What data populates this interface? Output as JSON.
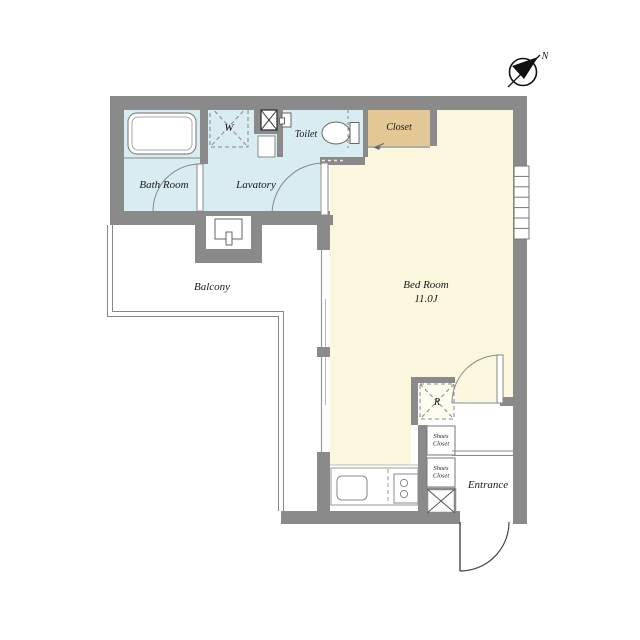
{
  "floorplan": {
    "rooms": {
      "bath": {
        "label": "Bath Room"
      },
      "lavatory": {
        "label": "Lavatory"
      },
      "toilet": {
        "label": "Toilet"
      },
      "closet": {
        "label": "Closet"
      },
      "bedroom": {
        "label": "Bed Room",
        "size": "11.0J"
      },
      "balcony": {
        "label": "Balcony"
      },
      "entrance": {
        "label": "Entrance"
      },
      "shoes_closet_upper": {
        "label_line1": "Shoes",
        "label_line2": "Closet"
      },
      "shoes_closet_lower": {
        "label_line1": "Shoes",
        "label_line2": "Closet"
      }
    },
    "appliances": {
      "washer": {
        "label": "W"
      },
      "refrigerator": {
        "label": "R"
      }
    },
    "compass": {
      "label": "N"
    },
    "colors": {
      "wall": "#8a8a8a",
      "wet_area": "#d9ecf1",
      "bedroom": "#fbf7df",
      "closet": "#e3c795",
      "line": "#777777",
      "text": "#1a1a1a"
    }
  }
}
